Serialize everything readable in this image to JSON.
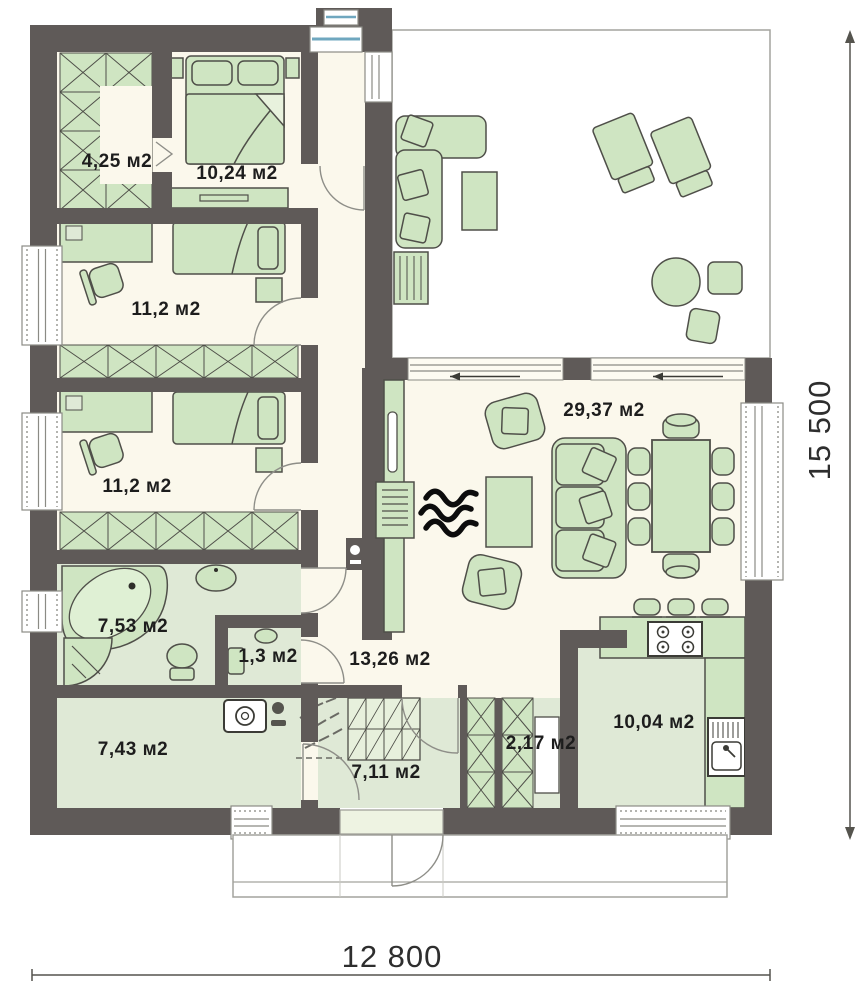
{
  "meta": {
    "type": "floor-plan",
    "units": "м2"
  },
  "rooms": [
    {
      "id": "wardrobe",
      "area_label": "4,25 м2"
    },
    {
      "id": "bedroom-main",
      "area_label": "10,24 м2"
    },
    {
      "id": "bedroom-1",
      "area_label": "11,2 м2"
    },
    {
      "id": "bedroom-2",
      "area_label": "11,2 м2"
    },
    {
      "id": "living-room",
      "area_label": "29,37 м2"
    },
    {
      "id": "bathroom",
      "area_label": "7,53 м2"
    },
    {
      "id": "wc",
      "area_label": "1,3 м2"
    },
    {
      "id": "hallway",
      "area_label": "13,26 м2"
    },
    {
      "id": "utility",
      "area_label": "7,43 м2"
    },
    {
      "id": "entry",
      "area_label": "7,11 м2"
    },
    {
      "id": "closet",
      "area_label": "2,17 м2"
    },
    {
      "id": "kitchen",
      "area_label": "10,04 м2"
    }
  ],
  "dimensions": {
    "width_label": "12 800",
    "height_label": "15 500"
  },
  "colors": {
    "wall": "#5f5a58",
    "floor": "#fbf8ec",
    "wet_floor": "#dfe9d6",
    "furniture": "#cfe5c2",
    "glass": "#6fa7bf"
  }
}
